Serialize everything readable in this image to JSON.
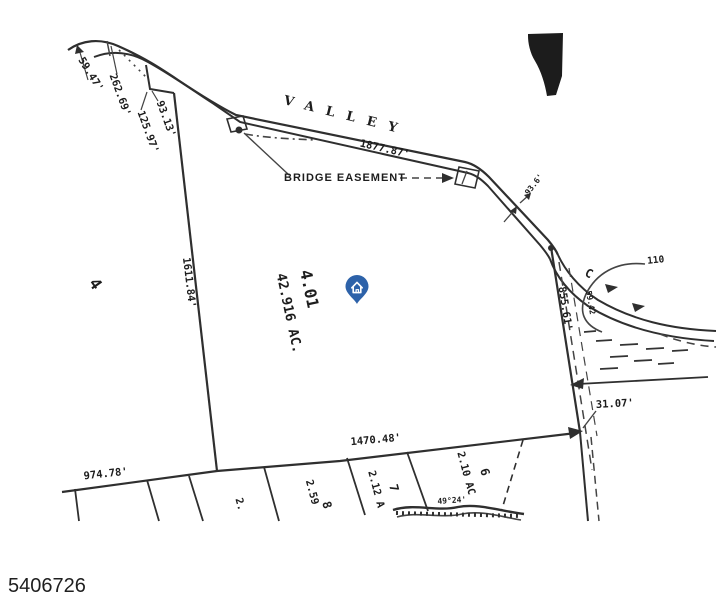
{
  "footer": {
    "photo_id": "5406726"
  },
  "pin": {
    "color": "#2d62a9",
    "icon": "house"
  },
  "map": {
    "road": {
      "name": "VALLEY",
      "frontage": "1877.87'",
      "station_small": "93.6'",
      "curve_letter": "C",
      "curve_small": "59.42",
      "ref_110": "110"
    },
    "easement": {
      "label": "BRIDGE EASEMENT"
    },
    "parcel": {
      "lot": "4.01",
      "area": "42.916 AC."
    },
    "dimensions": {
      "nw1": "59.47'",
      "nw2": "262.69'",
      "nw3": "93.13'",
      "nw4": "125.97'",
      "west": "1611.84'",
      "east": "855.61'",
      "east_jog": "31.07'",
      "south_main": "1470.48'",
      "south_west": "974.78'"
    },
    "adjacent": {
      "west_lot": "4",
      "lot9_area": "2.",
      "lot8_num": "8",
      "lot8_area": "2.59",
      "lot7_num": "7",
      "lot7_area": "2.12 A",
      "lot6_num": "6",
      "lot6_area": "2.10 AC",
      "bearing_small": "49°24'"
    }
  }
}
